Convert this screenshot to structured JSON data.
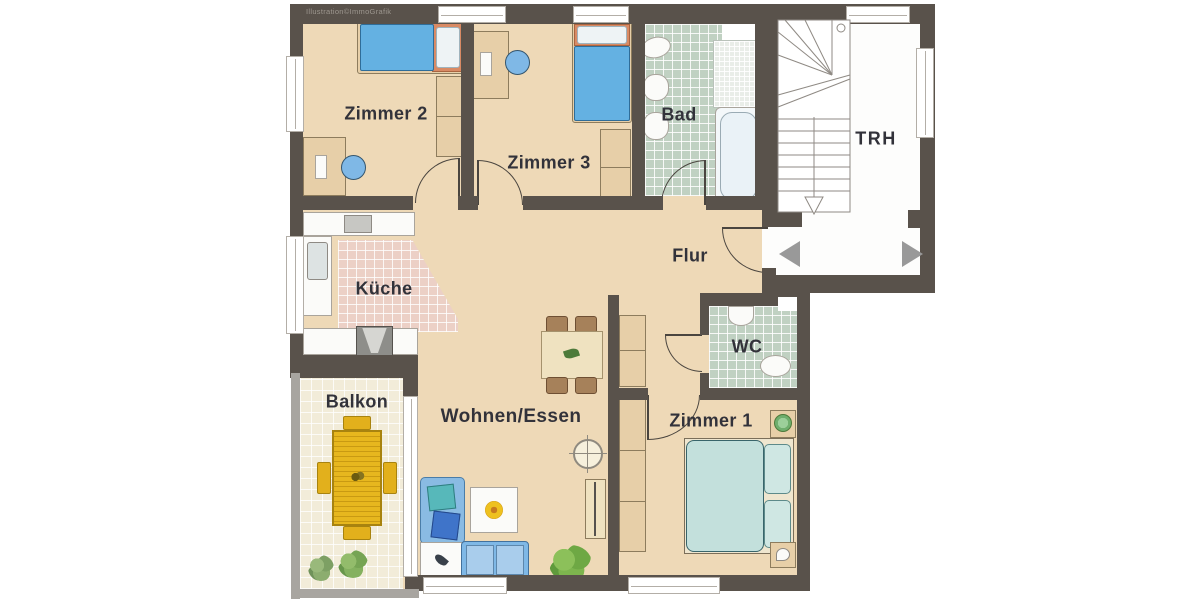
{
  "watermark": "Illustration©ImmoGrafik",
  "rooms": {
    "zimmer2": {
      "label": "Zimmer 2"
    },
    "zimmer3": {
      "label": "Zimmer 3"
    },
    "bad": {
      "label": "Bad"
    },
    "trh": {
      "label": "TRH"
    },
    "flur": {
      "label": "Flur"
    },
    "kueche": {
      "label": "Küche"
    },
    "wc": {
      "label": "WC"
    },
    "balkon": {
      "label": "Balkon"
    },
    "wohnen_essen": {
      "label": "Wohnen/Essen"
    },
    "zimmer1": {
      "label": "Zimmer 1"
    }
  },
  "colors": {
    "wall": "#59524b",
    "floor": "#eed9b7",
    "tile_green": "#c0d1c2",
    "tile_pink": "#ecd0c6",
    "tile_cream": "#f2ecd9",
    "tile_fine": "#e9ede8",
    "white_floor": "#fdfdfc",
    "bed_blue": "#64b1e2",
    "bed_teal": "#c3e0dc",
    "sofa_blue": "#7fb8e6",
    "furniture_tan": "#e7cfa8",
    "table_yellow": "#e7b71e",
    "label_text": "#32323a",
    "arrow_gray": "#999999",
    "railing_gray": "#a8a5a0"
  }
}
